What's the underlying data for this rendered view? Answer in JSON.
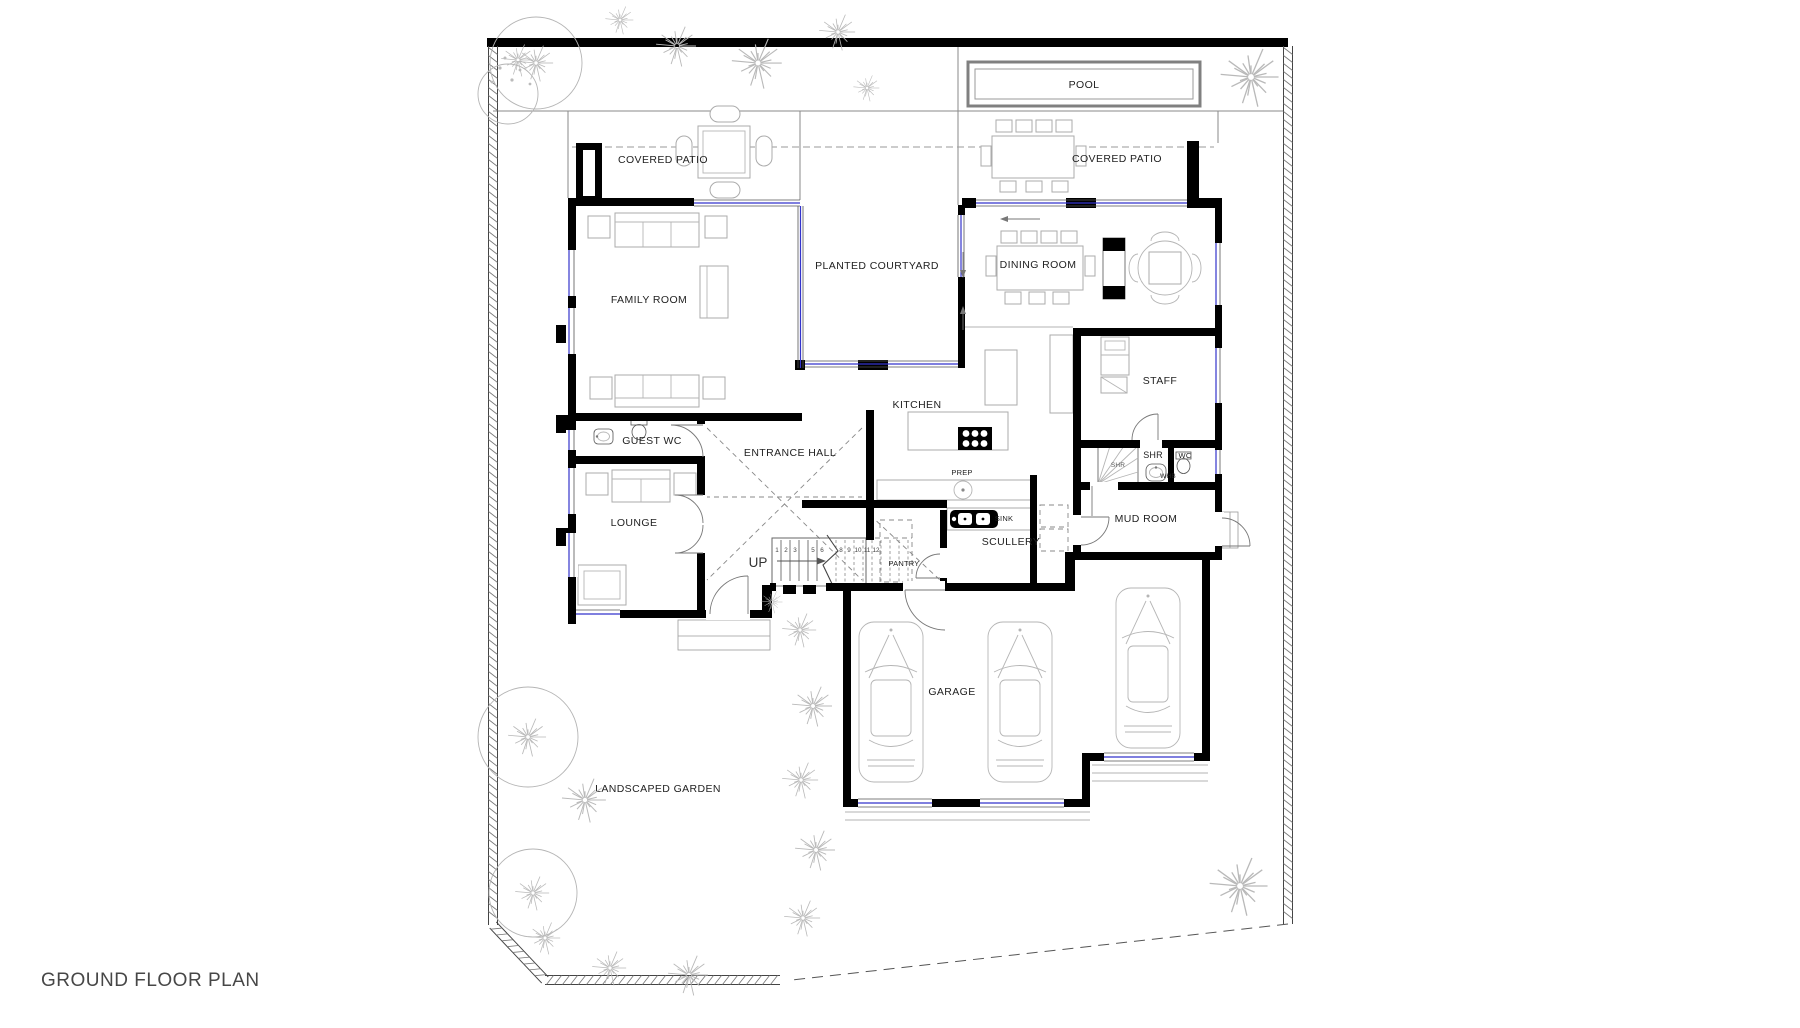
{
  "title": "GROUND FLOOR PLAN",
  "rooms": {
    "pool": "POOL",
    "covered_patio_left": "COVERED PATIO",
    "covered_patio_right": "COVERED PATIO",
    "family_room": "FAMILY ROOM",
    "planted_courtyard": "PLANTED COURTYARD",
    "dining_room": "DINING ROOM",
    "staff": "STAFF",
    "kitchen": "KITCHEN",
    "guest_wc": "GUEST WC",
    "entrance_hall": "ENTRANCE HALL",
    "lounge": "LOUNGE",
    "up": "UP",
    "pantry": "PANTRY",
    "prep": "PREP",
    "sink": "SINK",
    "scullery": "SCULLERY",
    "mud_room": "MUD ROOM",
    "shr": "SHR",
    "shr_inner": "SHR",
    "wc": "WC",
    "whb": "WHB",
    "garage": "GARAGE",
    "landscaped_garden": "LANDSCAPED GARDEN"
  },
  "stairs": {
    "treads": [
      "1",
      "2",
      "3",
      "5",
      "6",
      "8",
      "9",
      "10",
      "11",
      "12"
    ]
  },
  "colors": {
    "wall": "#000000",
    "glazing": "#3333cc",
    "thin_line": "#8a8a8a",
    "furniture": "#ababab",
    "tree": "#b9b9b9",
    "dashed": "#999999",
    "label_text": "#222222",
    "title_text": "#474747"
  }
}
